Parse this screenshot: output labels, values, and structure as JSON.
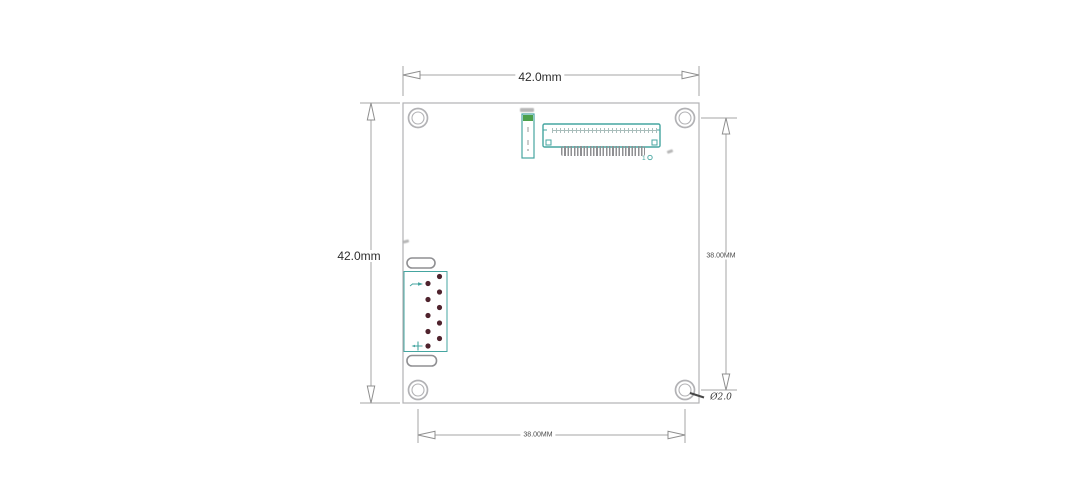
{
  "dimensions": {
    "top_width": "42.0mm",
    "left_height": "42.0mm",
    "right_hole_spacing": "38.00MM",
    "bottom_hole_spacing": "38.00MM",
    "hole_diameter_callout": "Ø2.0"
  },
  "board": {
    "mounting_hole_count": "4",
    "top_connector": {
      "pin_one_marker": "1"
    },
    "left_connector": {
      "pin_hole_count": "10"
    }
  },
  "colors": {
    "connector_teal": "#45a5a0",
    "component_green": "#4ba04b",
    "pin_hole_maroon": "#4f232d",
    "outline_gray": "#b2b2b5",
    "dimension_gray": "#a5a5a5"
  }
}
